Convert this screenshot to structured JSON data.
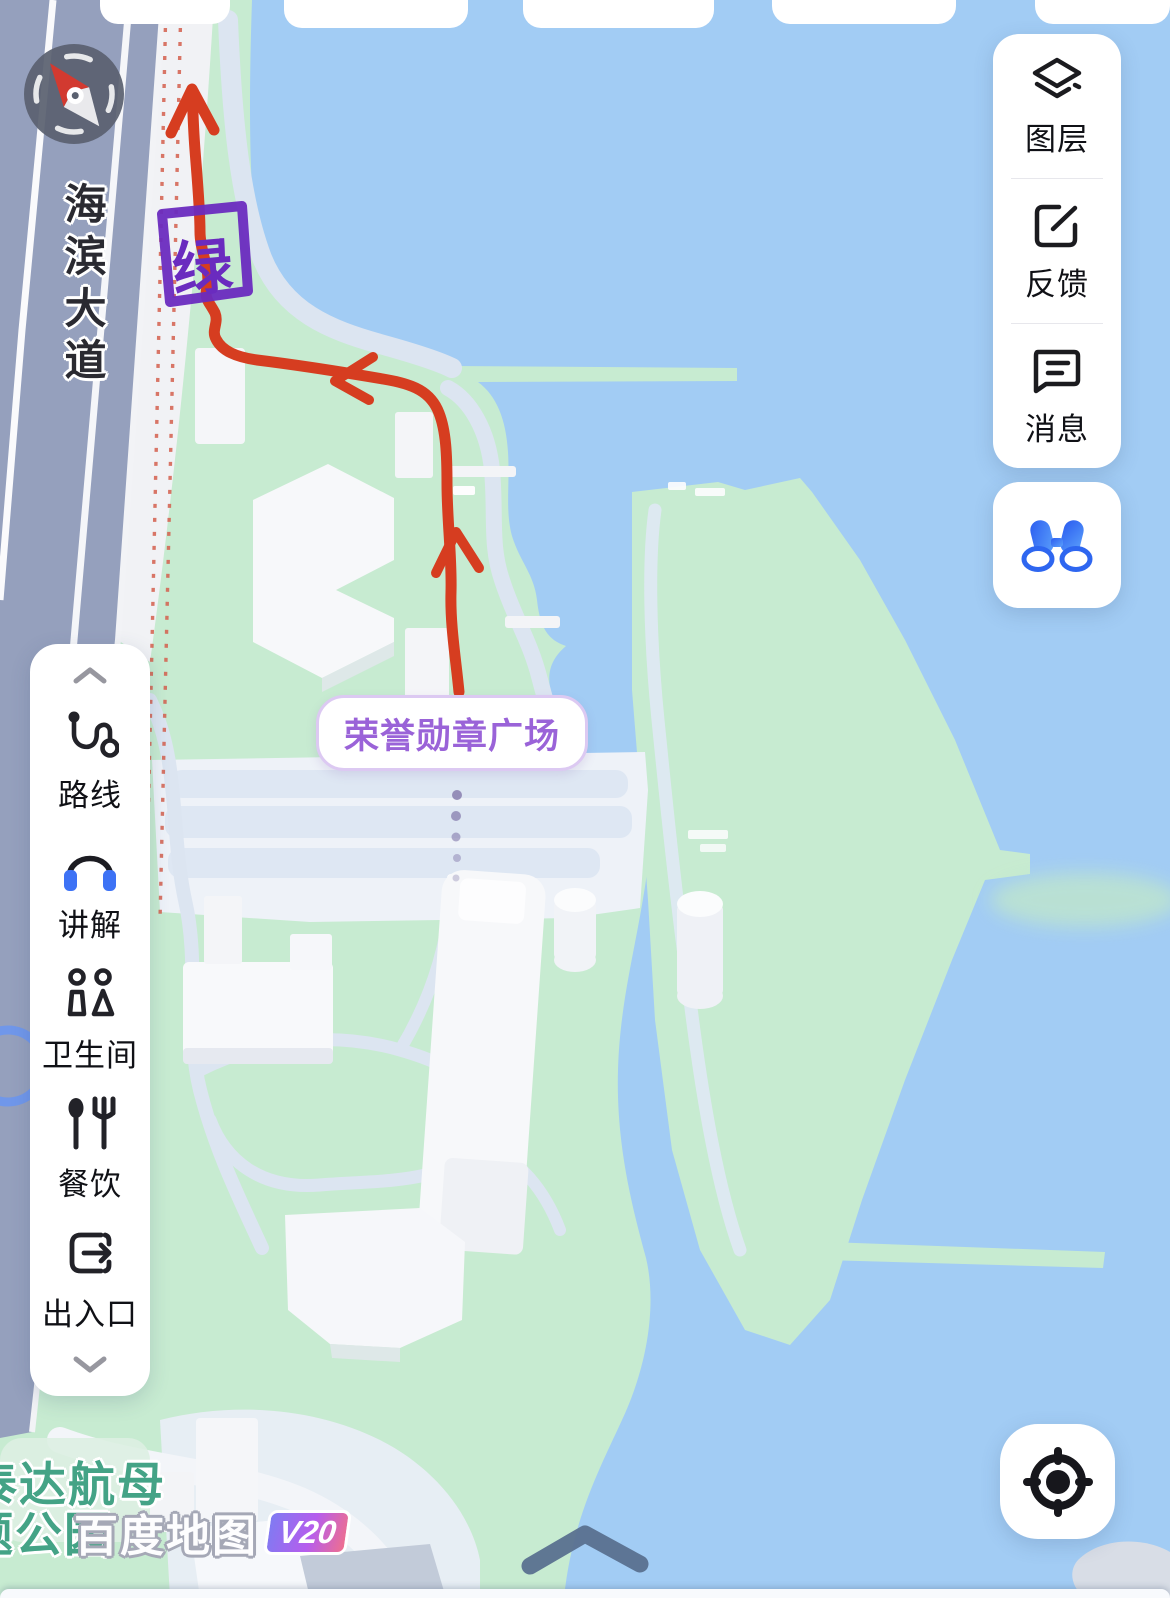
{
  "map": {
    "road_label": "海滨大道",
    "poi_bubble": "荣誉勋章广场",
    "annotation_char": "绿",
    "park_label_line1": "泰达航母",
    "park_label_line2": "题公园",
    "watermark_text": "百度地图",
    "watermark_version": "V20"
  },
  "right_panel": {
    "items": [
      {
        "label": "图层",
        "icon": "layers-icon"
      },
      {
        "label": "反馈",
        "icon": "feedback-icon"
      },
      {
        "label": "消息",
        "icon": "message-icon"
      }
    ]
  },
  "tour_button": {
    "icon": "binoculars-icon"
  },
  "left_panel": {
    "items": [
      {
        "label": "路线",
        "icon": "route-icon"
      },
      {
        "label": "讲解",
        "icon": "headphones-icon"
      },
      {
        "label": "卫生间",
        "icon": "toilet-people-icon"
      },
      {
        "label": "餐饮",
        "icon": "cutlery-icon"
      },
      {
        "label": "出入口",
        "icon": "exit-icon"
      }
    ]
  },
  "colors": {
    "water": "#a2ccf4",
    "land_green": "#c7ebd1",
    "road": "#95a0bd",
    "route_red": "#d63d20",
    "annotation_purple": "#6a2bbf",
    "poi_purple": "#9a63d8",
    "icon_blue": "#3d72f5",
    "park_label_green": "#44a386"
  }
}
